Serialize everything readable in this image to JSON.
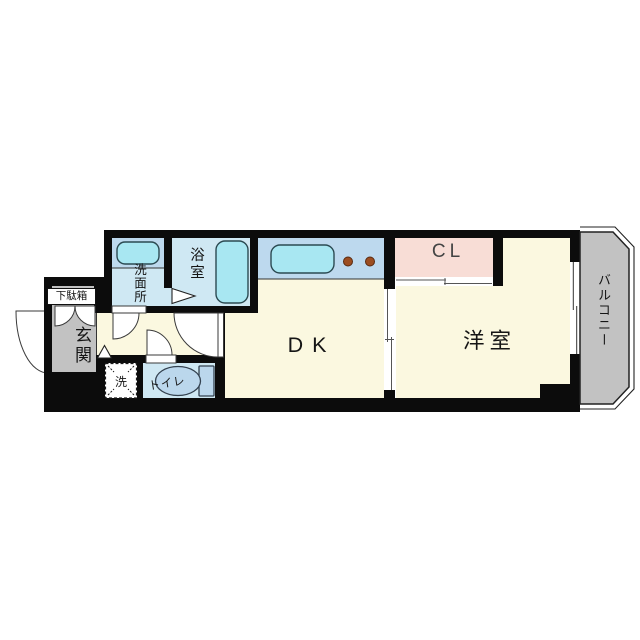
{
  "plan": {
    "rooms": {
      "getabako": "下駄箱",
      "genkan": "玄関",
      "senmenjo": "洗面所",
      "yokushitsu": "浴室",
      "laundry": "洗",
      "toilet": "トイレ",
      "dk": "DK",
      "closet": "CL",
      "western_room": "洋室",
      "balcony": "バルコニー"
    },
    "colors": {
      "wall": "#0c0c0c",
      "room_cream": "#FBF8E0",
      "entrance_gray": "#C2C2C2",
      "balcony_gray": "#C2C2C2",
      "wet_area_blue": "#CFE8F3",
      "counter_blue": "#BDD9EE",
      "fixture_cyan": "#A8E7F2",
      "toilet_fixture_blue": "#BBD7EC",
      "closet_pink": "#F8DDD6",
      "burner_brown": "#9C4D20"
    }
  }
}
